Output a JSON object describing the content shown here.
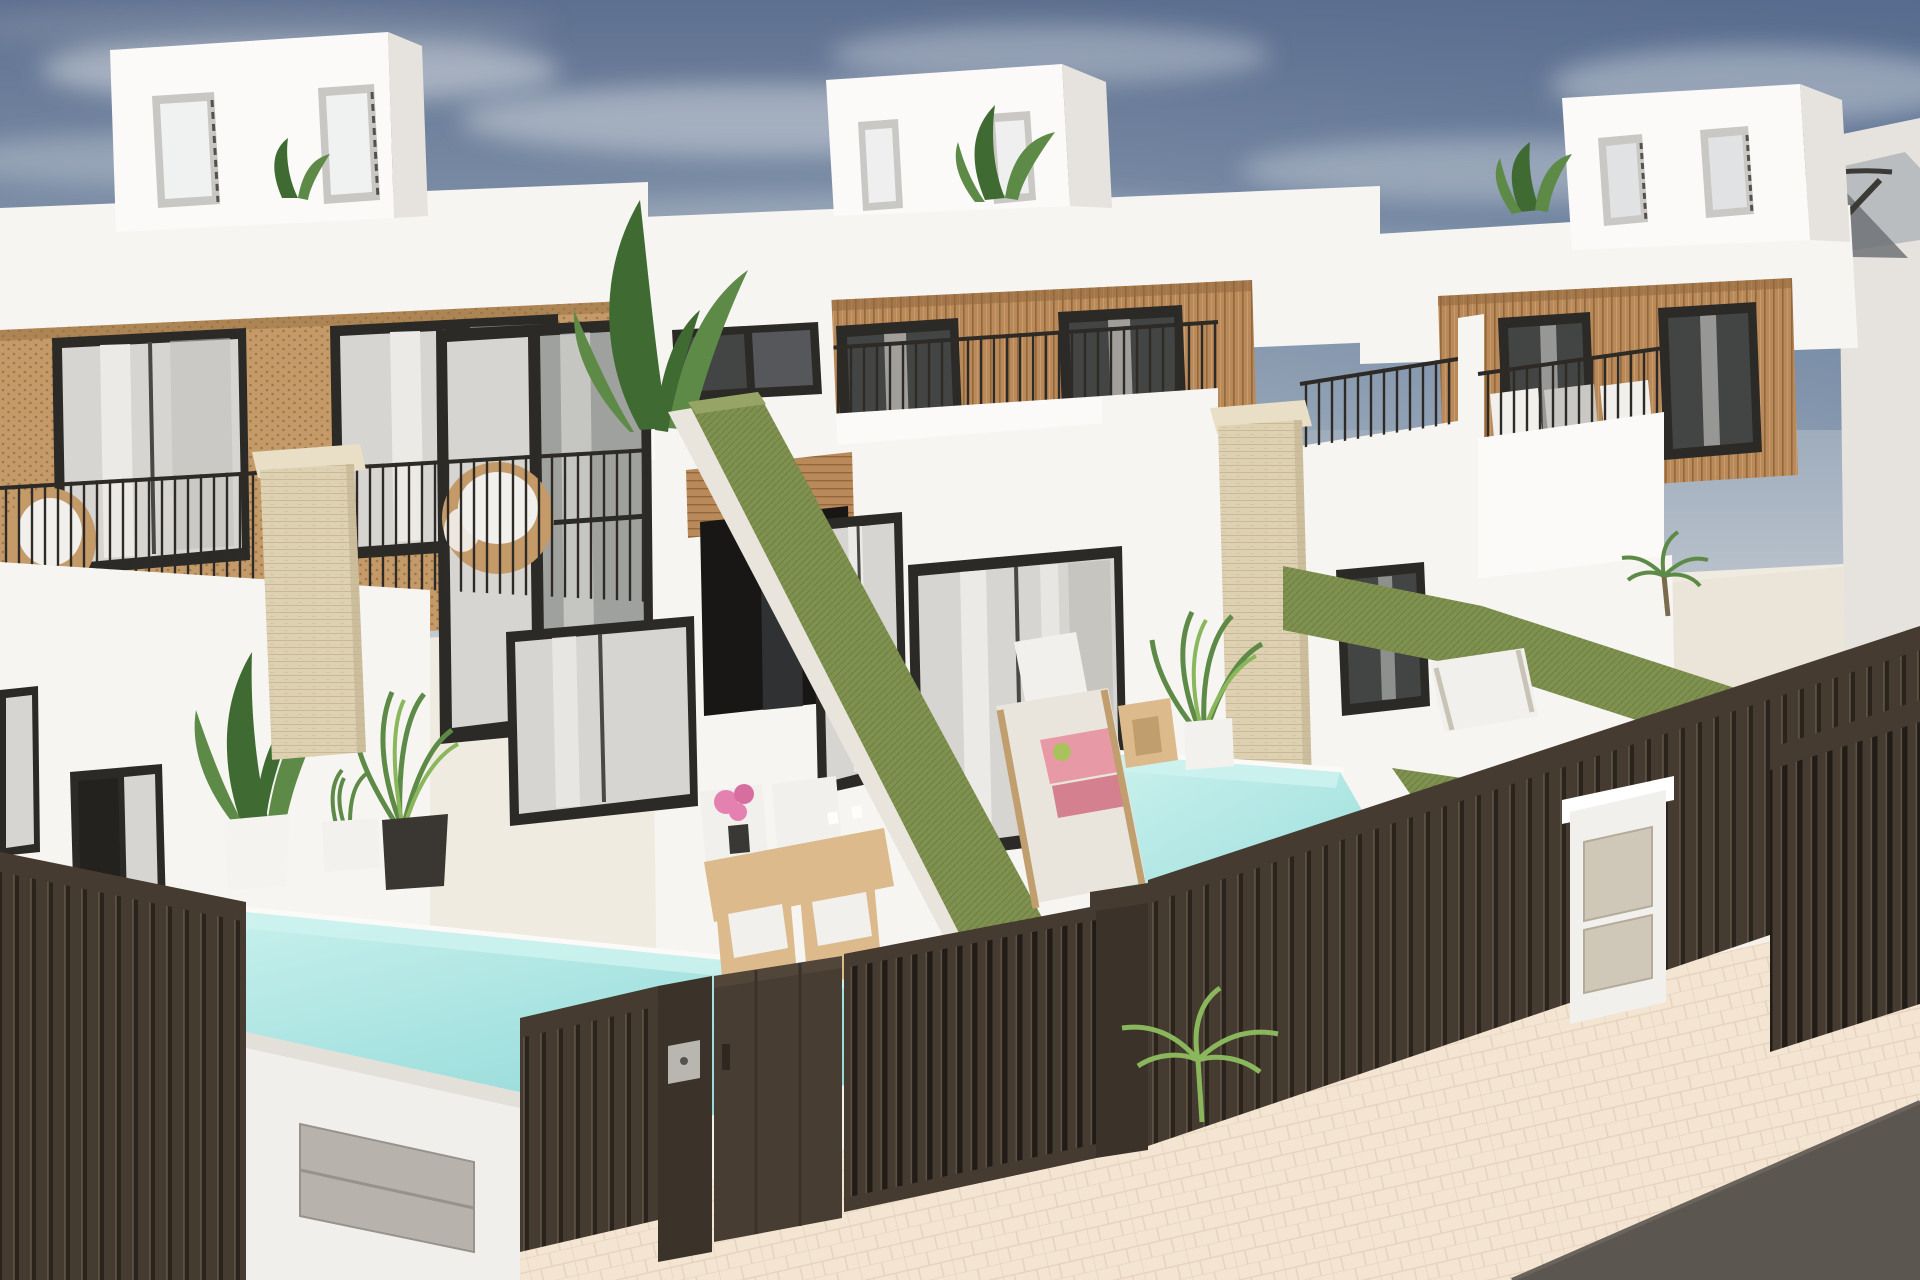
{
  "scene": {
    "kind": "architectural-render",
    "subject": "row of modern two-storey white villas with rooftop terraces, private pools, hedge dividers and dark slatted street fence",
    "villa_count_visible": 3,
    "pool_count_visible": 2,
    "hedge_band_count": 4,
    "text_content": ""
  },
  "colors": {
    "sky-top": "#5e7090",
    "sky-mid": "#8fa0b3",
    "sky-horizon": "#ccd1d7",
    "cloud": "#d8dce1",
    "cloud-dark": "#8795a8",
    "wall-white": "#f6f5f2",
    "wall-light": "#fbfaf8",
    "wall-shade": "#e6e3de",
    "wall-shade2": "#d9d5cf",
    "frame-dark": "#2b2a27",
    "glass-light": "#d6d5d1",
    "glass-dark": "#434544",
    "curtain": "#eceae6",
    "interior-dark": "#181715",
    "wood": "#b9895a",
    "wood-dark": "#92683d",
    "wood-light": "#d3a876",
    "rattan": "#c59a69",
    "rattan-dot": "#956f41",
    "travertine": "#ddd1b2",
    "trav-line": "#c4b693",
    "railing": "#2e2b27",
    "hedge": "#7f914f",
    "hedge-dark": "#69793f",
    "hedge-light": "#96a565",
    "pool-wall": "#cdf2ee",
    "pool-mid": "#a5e2e0",
    "pool-deep": "#88cdd0",
    "deck": "#f0ebe0",
    "deck-shade": "#e7dfd1",
    "fence": "#453b31",
    "fence-hi": "#5d5044",
    "fence-gap": "#2a241d",
    "fence-dark": "#3b322a",
    "fence-door": "#473d33",
    "meter-gray": "#b7b3ac",
    "meter-beige": "#cfc7b8",
    "pavement": "#f4e5d3",
    "paver-line": "#e3cfba",
    "road": "#5b564f",
    "furn-wood": "#dcba8c",
    "furn-wood-dark": "#c19e6d",
    "cushion": "#f1f0ed",
    "cushion-gray": "#c9c8c4",
    "towel-pink": "#e79aa6",
    "towel-pink2": "#d5808e",
    "flower-pink": "#e481b0",
    "plant-green": "#5d8a46",
    "plant-dark": "#3f6b33",
    "plant-light": "#8ab65c",
    "plant-yellow": "#a9c25d",
    "parasol": "#babdbf",
    "parasol-dark": "#6f7275"
  }
}
